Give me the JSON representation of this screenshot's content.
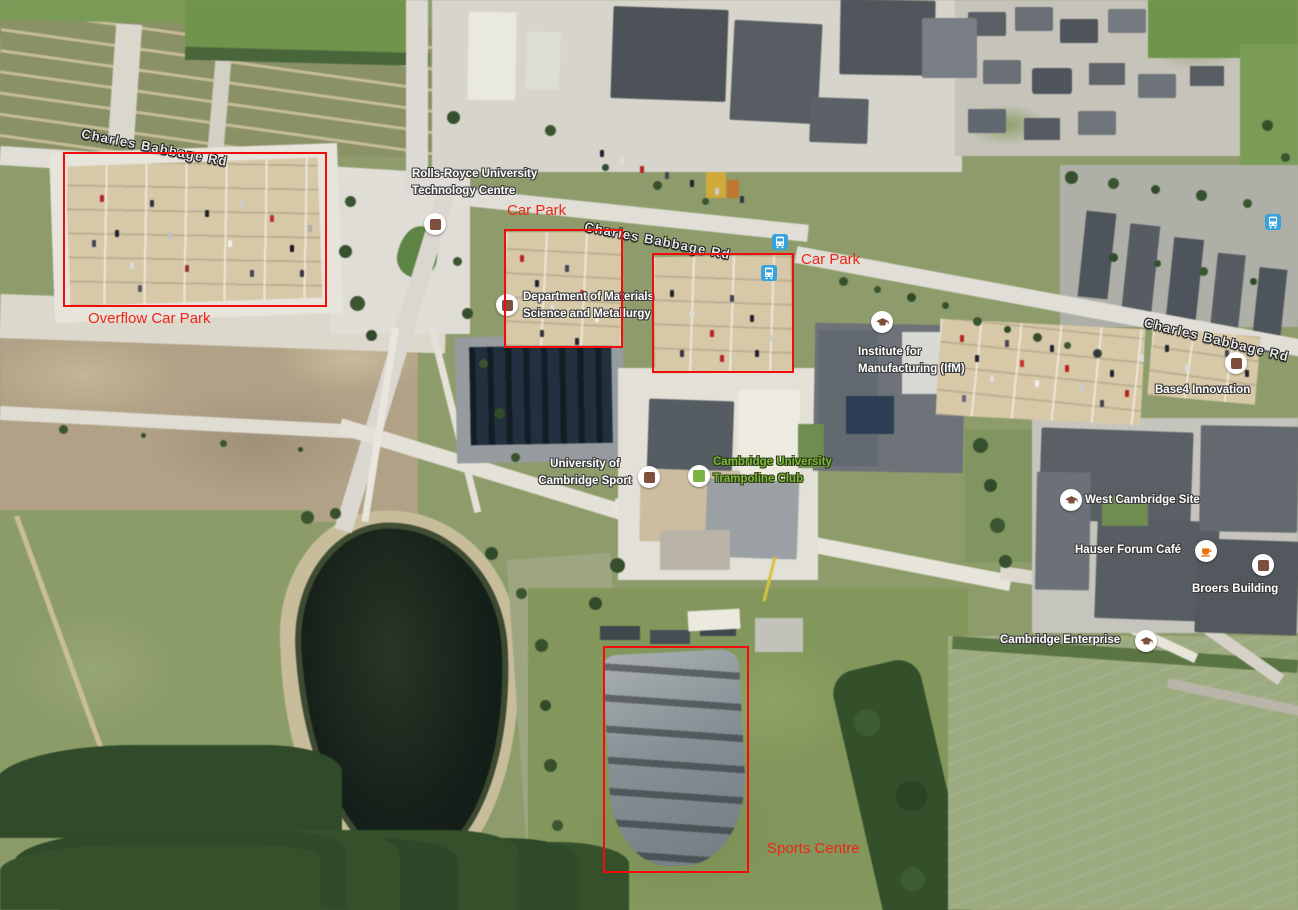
{
  "map": {
    "description": "Satellite map of West Cambridge Site with red annotation overlays",
    "road_labels": [
      {
        "id": "charles-babbage-rd-west",
        "text": "Charles Babbage Rd"
      },
      {
        "id": "charles-babbage-rd-center",
        "text": "Charles Babbage Rd"
      },
      {
        "id": "charles-babbage-rd-east",
        "text": "Charles Babbage Rd"
      }
    ],
    "pois": [
      {
        "id": "rolls-royce-utc",
        "line1": "Rolls-Royce University",
        "line2": "Technology Centre",
        "icon": "place-marker"
      },
      {
        "id": "materials-science",
        "line1": "Department of Materials",
        "line2": "Science and Metallurgy",
        "icon": "place-marker"
      },
      {
        "id": "institute-manufacturing",
        "line1": "Institute for",
        "line2": "Manufacturing (IfM)",
        "icon": "graduation-cap"
      },
      {
        "id": "base4-innovation",
        "line1": "Base4 Innovation",
        "icon": "place-marker"
      },
      {
        "id": "university-cambridge-sport",
        "line1": "University of",
        "line2": "Cambridge Sport",
        "icon": "place-marker"
      },
      {
        "id": "trampoline-club",
        "line1": "Cambridge University",
        "line2": "Trampoline Club",
        "icon": "green-square",
        "color": "#7cb342"
      },
      {
        "id": "west-cambridge-site",
        "line1": "West Cambridge Site",
        "icon": "graduation-cap"
      },
      {
        "id": "hauser-forum-cafe",
        "line1": "Hauser Forum Café",
        "icon": "coffee-cup"
      },
      {
        "id": "broers-building",
        "line1": "Broers Building",
        "icon": "place-marker"
      },
      {
        "id": "cambridge-enterprise",
        "line1": "Cambridge Enterprise",
        "icon": "graduation-cap"
      }
    ],
    "annotations": [
      {
        "id": "overflow-car-park",
        "label": "Overflow Car Park"
      },
      {
        "id": "car-park-west",
        "label": "Car Park"
      },
      {
        "id": "car-park-east",
        "label": "Car Park"
      },
      {
        "id": "sports-centre",
        "label": "Sports Centre"
      }
    ],
    "transit": {
      "bus_stop_count": 3
    },
    "colors": {
      "annotation_red": "#f20c0c",
      "annotation_text_red": "#ee2518",
      "poi_green": "#7cb342",
      "bus_blue": "#36a3dc",
      "cafe_orange": "#e8710a",
      "marker_brown": "#7d4f3c"
    }
  }
}
